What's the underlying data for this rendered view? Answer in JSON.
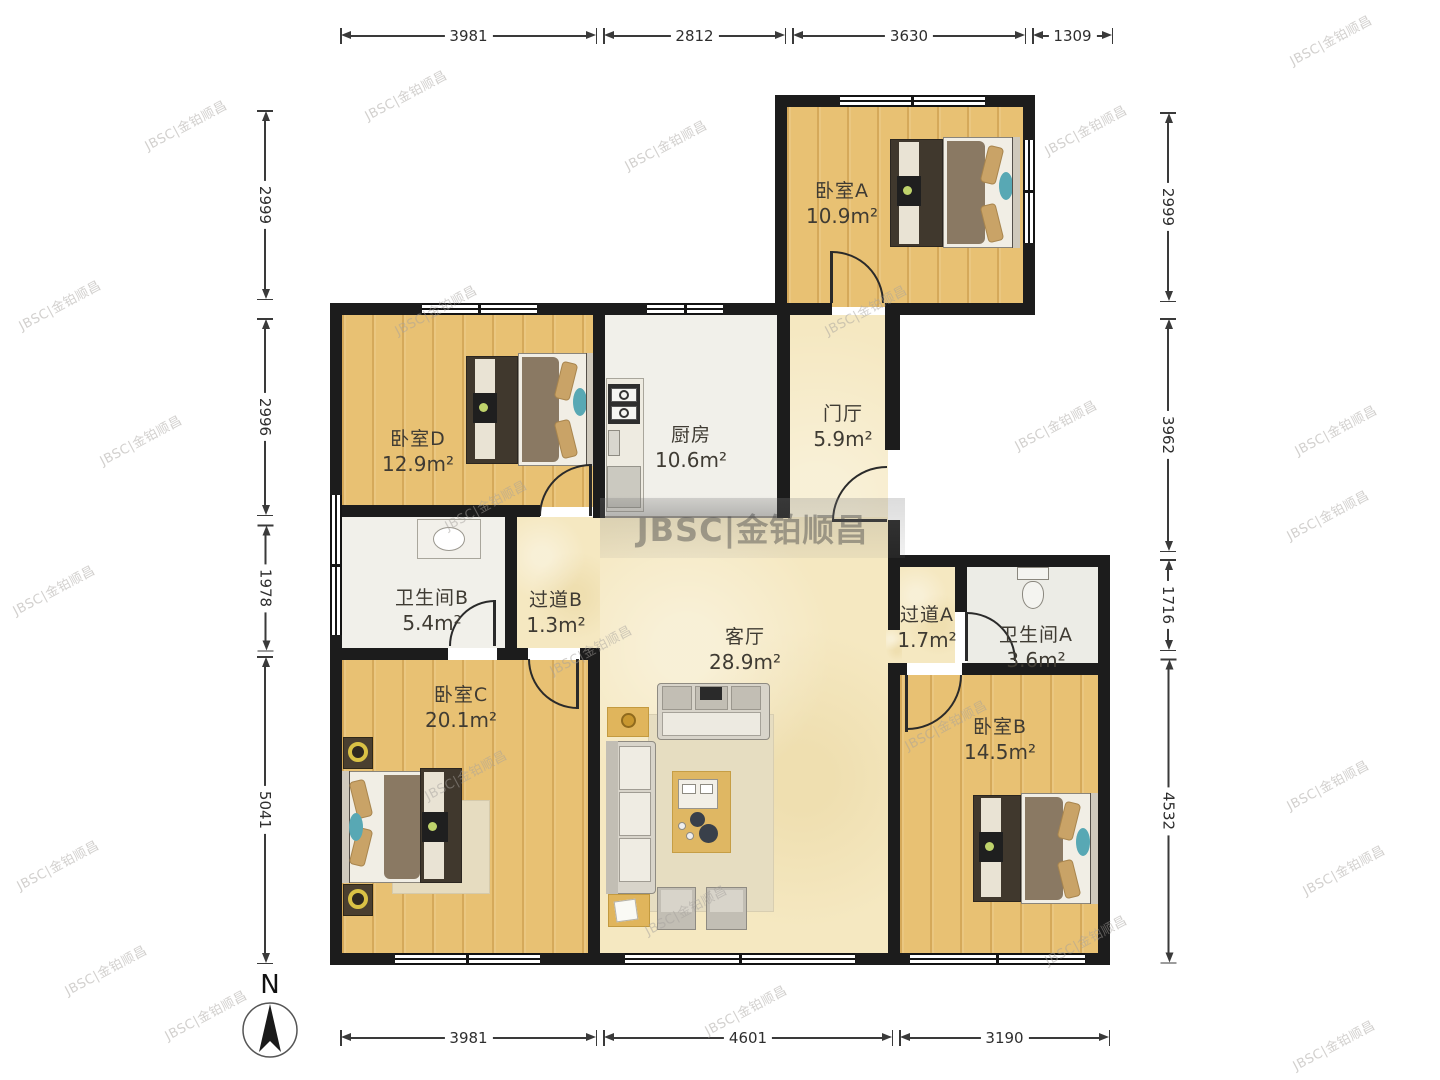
{
  "watermark": {
    "text": "JBSC|金铂顺昌"
  },
  "compass": {
    "label": "N"
  },
  "rooms": {
    "bedroomA": {
      "name": "卧室A",
      "area": "10.9m²"
    },
    "bedroomD": {
      "name": "卧室D",
      "area": "12.9m²"
    },
    "kitchen": {
      "name": "厨房",
      "area": "10.6m²"
    },
    "entry": {
      "name": "门厅",
      "area": "5.9m²"
    },
    "bathroomB": {
      "name": "卫生间B",
      "area": "5.4m²"
    },
    "corridorB": {
      "name": "过道B",
      "area": "1.3m²"
    },
    "living": {
      "name": "客厅",
      "area": "28.9m²"
    },
    "corridorA": {
      "name": "过道A",
      "area": "1.7m²"
    },
    "bathroomA": {
      "name": "卫生间A",
      "area": "3.6m²"
    },
    "bedroomC": {
      "name": "卧室C",
      "area": "20.1m²"
    },
    "bedroomB": {
      "name": "卧室B",
      "area": "14.5m²"
    }
  },
  "dimensions": {
    "top": [
      "3981",
      "2812",
      "3630",
      "1309"
    ],
    "bottom": [
      "3981",
      "4601",
      "3190"
    ],
    "left": [
      "2999",
      "2996",
      "1978",
      "5041"
    ],
    "right": [
      "2999",
      "3962",
      "1716",
      "4532"
    ]
  }
}
